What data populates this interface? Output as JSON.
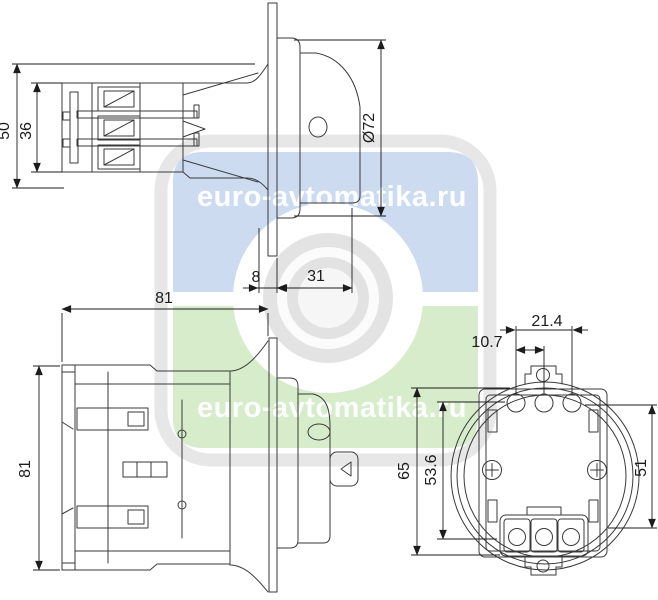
{
  "watermark": {
    "text": "euro-avtomatika.ru",
    "colors": {
      "accent_blue": "#cddbf0",
      "accent_green": "#d6ecca",
      "logo_gray": "#e7e7e7",
      "lens_gray": "#e3e3e3",
      "line": "#3a3a3a"
    }
  },
  "views": {
    "side": {
      "dims": {
        "overall_height": "50",
        "terminal_height": "36",
        "panel_gap": "8",
        "front_depth": "31",
        "flange_diameter": "Ø72"
      }
    },
    "top": {
      "dims": {
        "width": "81",
        "height": "81"
      }
    },
    "rear": {
      "dims": {
        "hole_pitch_outer": "21.4",
        "hole_pitch_inner": "10.7",
        "overall_height": "65",
        "body_height": "53.6",
        "side_height": "51"
      }
    }
  }
}
